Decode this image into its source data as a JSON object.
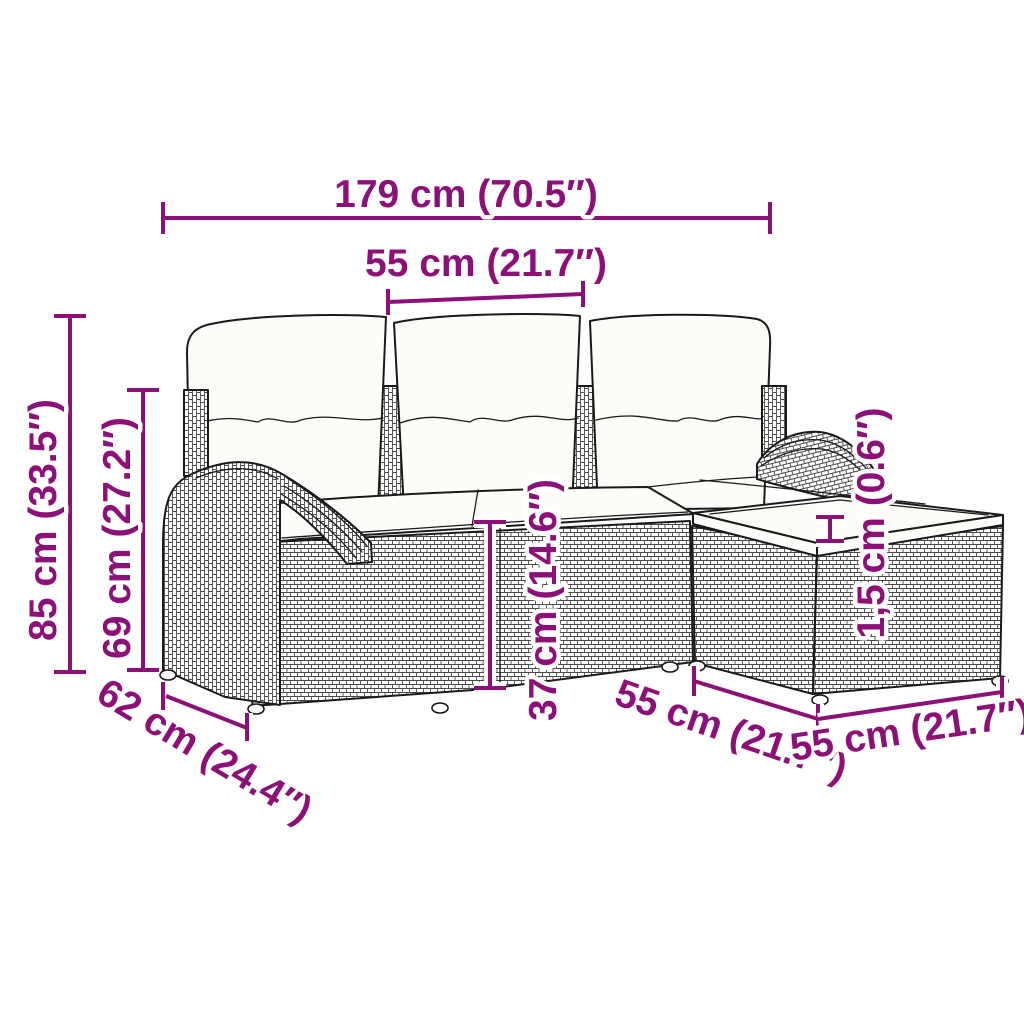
{
  "diagram": {
    "kind": "furniture-dimension-diagram",
    "accent_color": "#8C1077",
    "line_color": "#1a1a1a",
    "background_color": "#ffffff",
    "dimensions": {
      "total_width": "179 cm (70.5″)",
      "module_width_top": "55 cm (21.7″)",
      "total_height": "85 cm (33.5″)",
      "back_height": "69 cm (27.2″)",
      "seat_height": "37 cm (14.6″)",
      "cushion_thickness": "1,5 cm (0.6″)",
      "depth": "62 cm (24.4″)",
      "ottoman_width_left": "55 cm (21.7″)",
      "ottoman_width_right": "55 cm (21.7″)"
    }
  }
}
